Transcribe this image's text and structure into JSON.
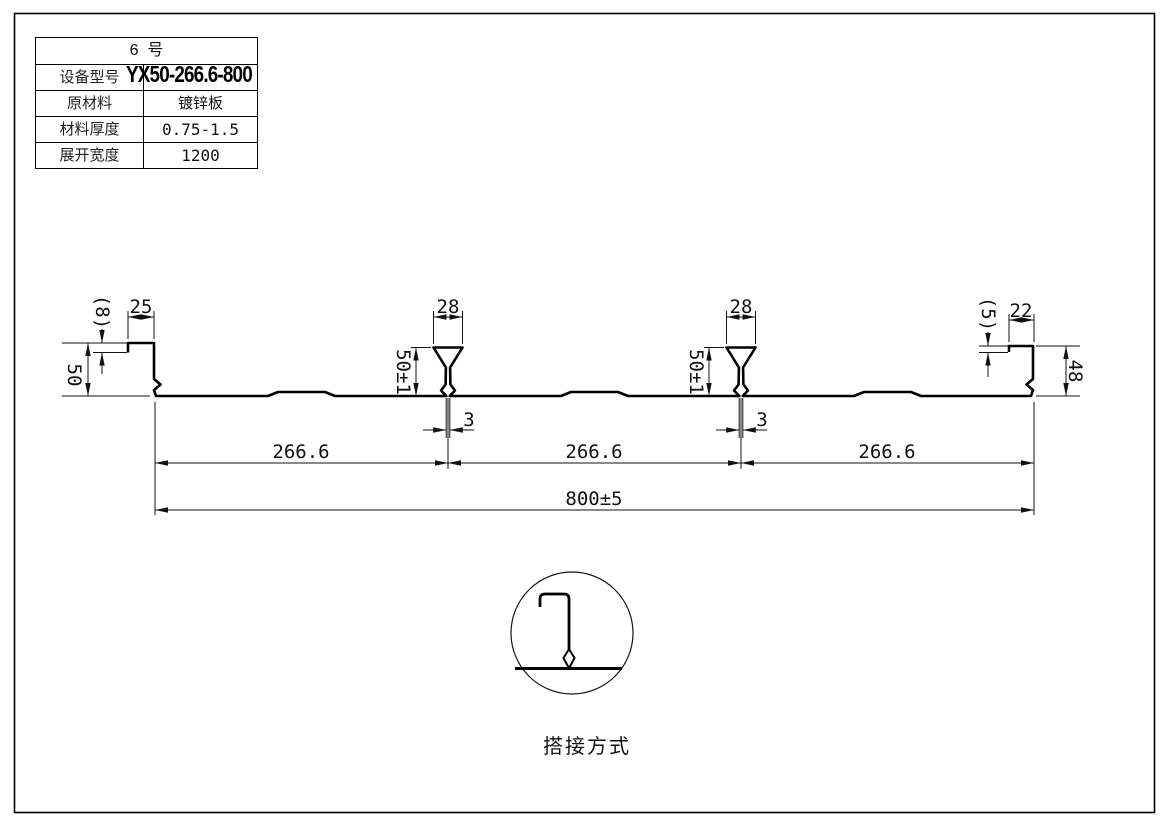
{
  "drawing": {
    "title_block": {
      "header": "6  号",
      "rows": [
        {
          "label": "设备型号",
          "value": "YX50-266.6-800"
        },
        {
          "label": "原材料",
          "value": "镀锌板"
        },
        {
          "label": "材料厚度",
          "value": "0.75-1.5"
        },
        {
          "label": "展开宽度",
          "value": "1200"
        }
      ]
    },
    "dims": {
      "left_step": "(8)",
      "left_lip": "25",
      "left_height": "50",
      "rib1_top": "28",
      "rib1_height": "50±1",
      "rib1_slot": "3",
      "rib2_top": "28",
      "rib2_height": "50±1",
      "rib2_slot": "3",
      "right_step": "(5)",
      "right_lip": "22",
      "right_height": "48",
      "span1": "266.6",
      "span2": "266.6",
      "span3": "266.6",
      "overall": "800±5"
    },
    "detail_caption": "搭接方式",
    "colors": {
      "line": "#000000",
      "dim": "#111111",
      "bg": "#ffffff"
    }
  }
}
